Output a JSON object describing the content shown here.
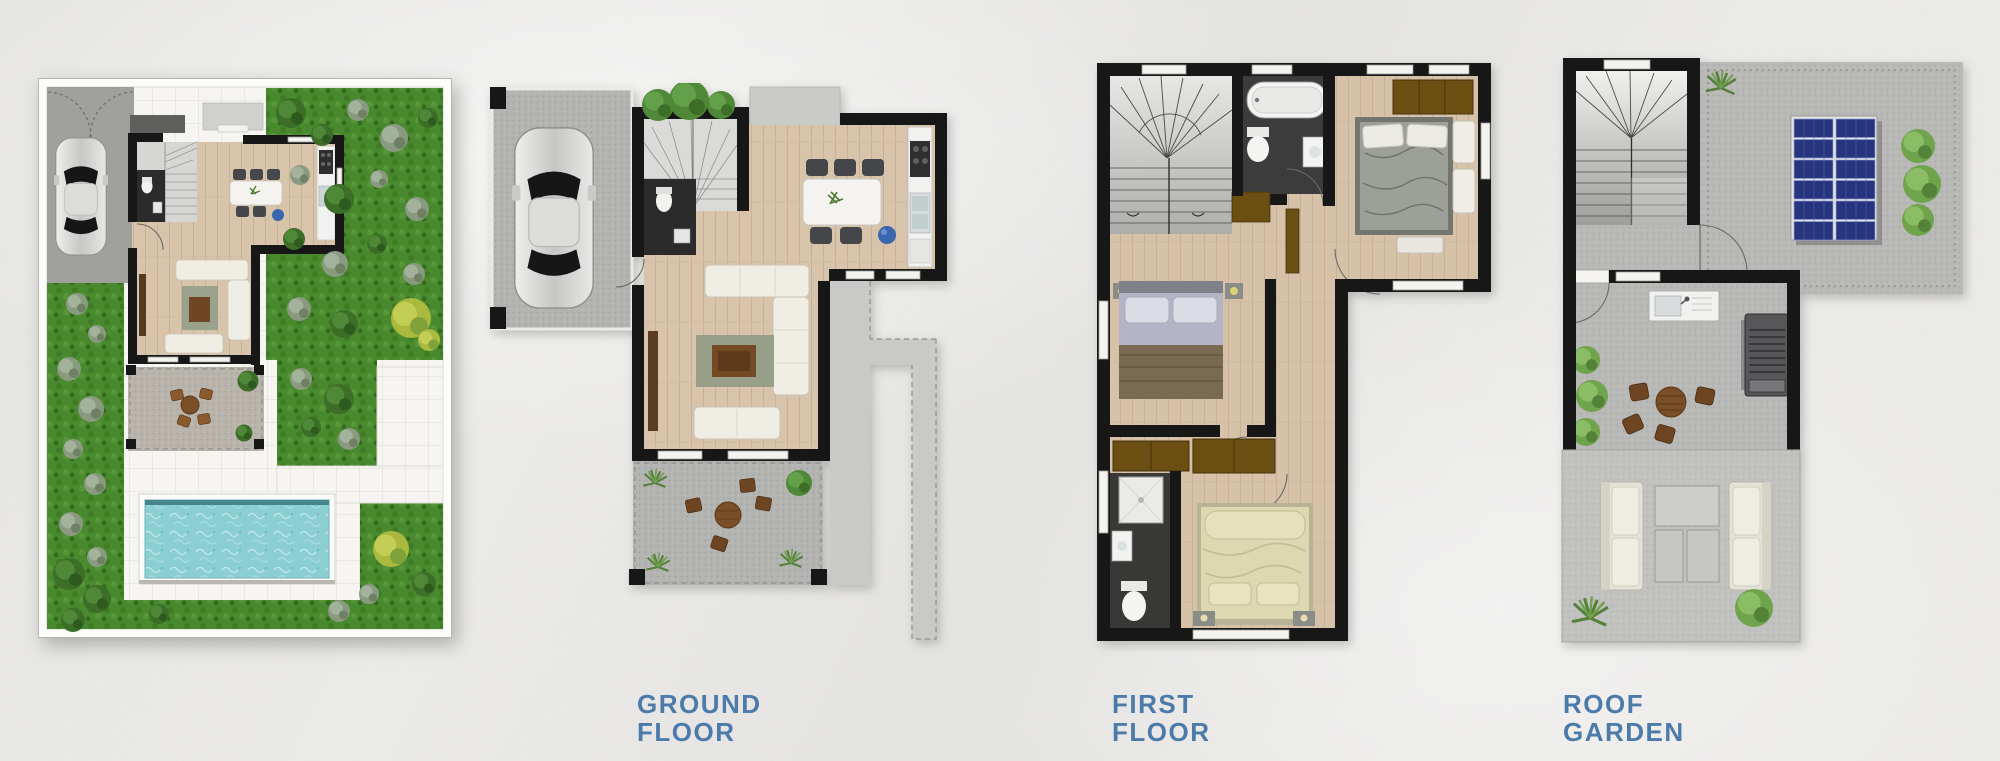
{
  "page": {
    "background_color": "#edecea",
    "description": "architectural floor plan sheet on crumpled paper background"
  },
  "colors": {
    "label_text": "#4d7ba9",
    "wall": "#171717",
    "wood_floor": "#d8c3ab",
    "grass": "#4a8a2e",
    "pool_water": "#8ccfd3",
    "concrete": "#b6b6b4",
    "white_tile": "#f6f5f1",
    "solar_panel": "#26357e",
    "wardrobe_brown": "#6b4e12"
  },
  "labels": {
    "ground_floor": {
      "line1": "GROUND",
      "line2": "FLOOR"
    },
    "first_floor": {
      "line1": "FIRST",
      "line2": "FLOOR"
    },
    "roof_garden": {
      "line1": "ROOF",
      "line2": "GARDEN"
    }
  },
  "plans": [
    {
      "id": "site-plan",
      "label": null,
      "features": [
        "garden",
        "driveway",
        "car",
        "house-outline",
        "patio-seating",
        "swimming-pool",
        "tiled-walkway",
        "shrubs"
      ]
    },
    {
      "id": "ground-floor-plan",
      "label": "GROUND FLOOR",
      "features": [
        "carport",
        "car",
        "entrance-porch",
        "staircase",
        "wc",
        "dining-table",
        "kitchen",
        "living-room-sofas",
        "terrace-seating",
        "side-path",
        "shrubs"
      ]
    },
    {
      "id": "first-floor-plan",
      "label": "FIRST FLOOR",
      "features": [
        "staircase",
        "bathroom",
        "bathtub",
        "bedroom",
        "bedroom",
        "bedroom",
        "en-suite-shower",
        "wardrobes",
        "hallway"
      ]
    },
    {
      "id": "roof-garden-plan",
      "label": "ROOF GARDEN",
      "features": [
        "staircase",
        "roof-terrace",
        "solar-panels",
        "outdoor-sink",
        "bbq-grill",
        "outdoor-dining-set",
        "lounge-sofas",
        "planting"
      ]
    }
  ]
}
